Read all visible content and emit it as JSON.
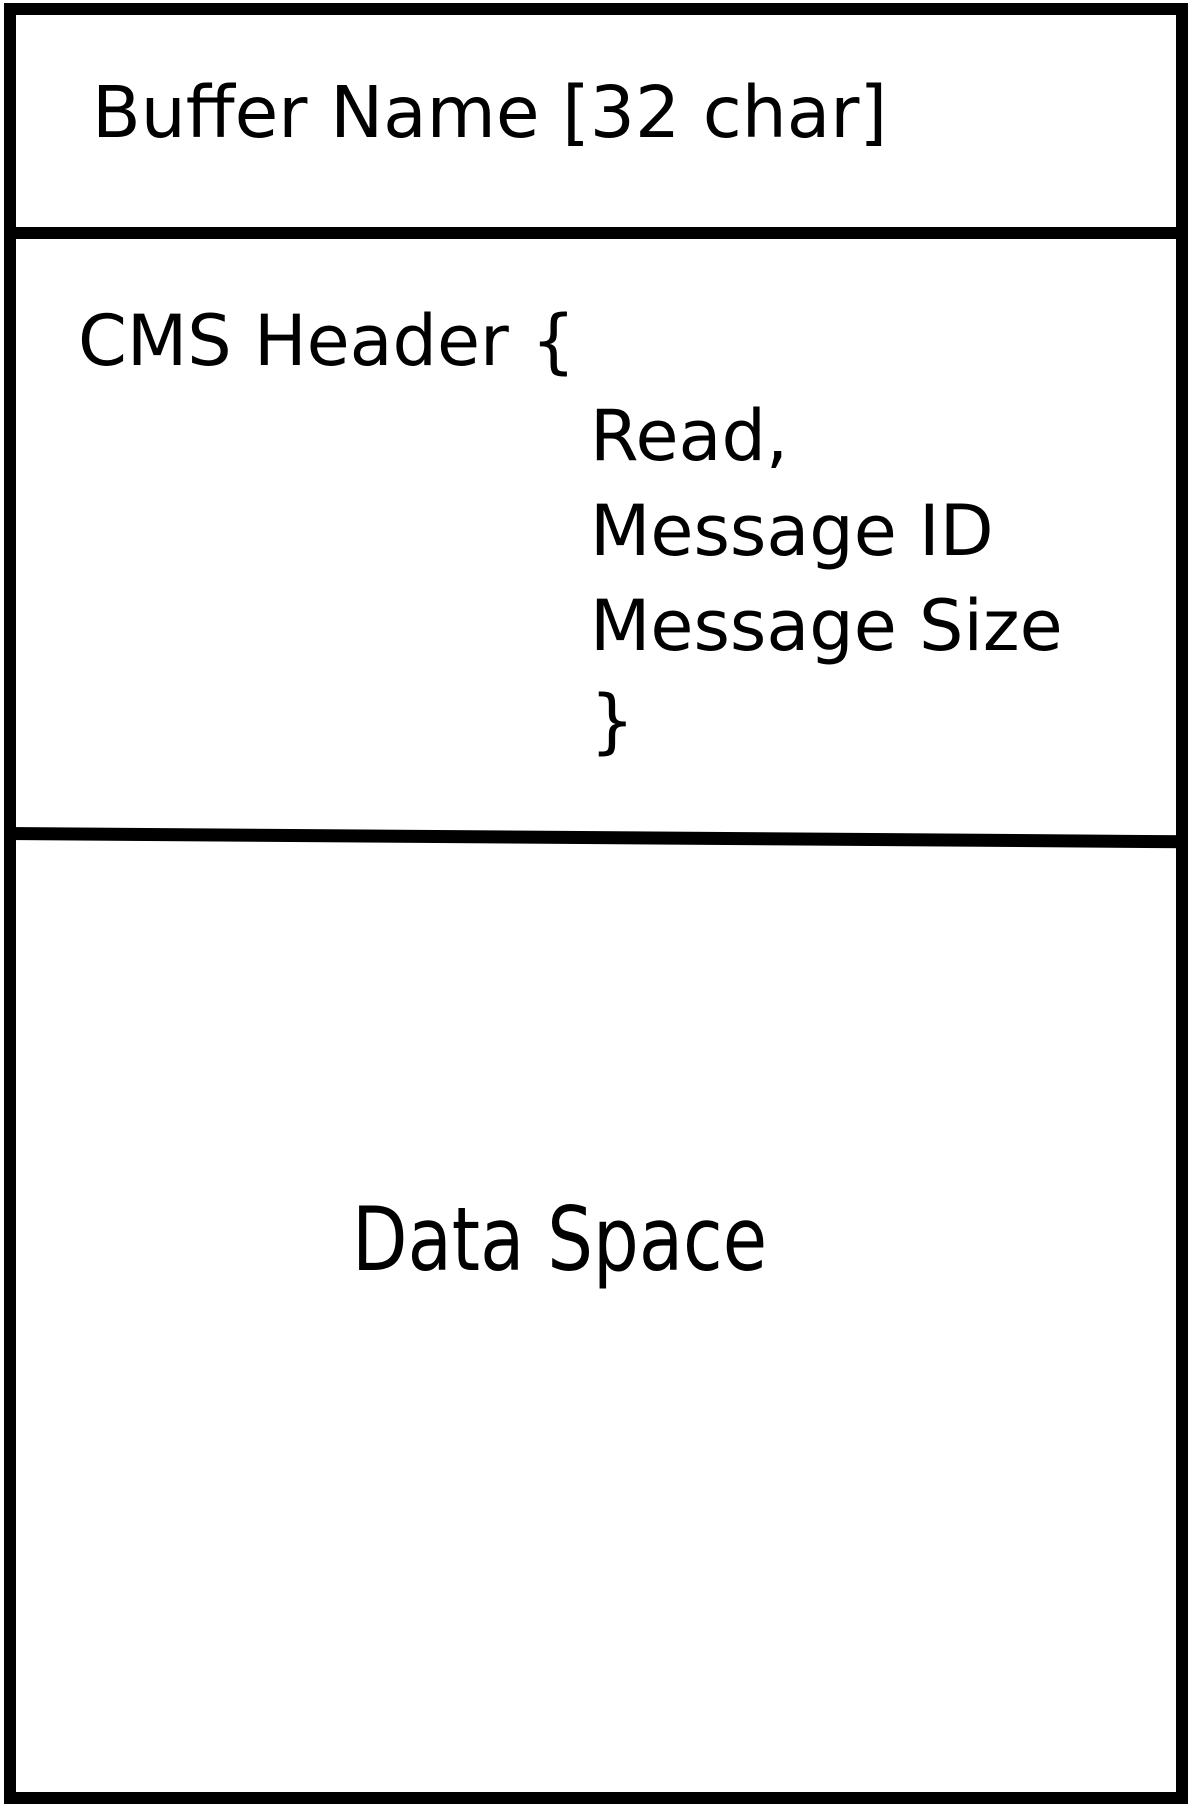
{
  "colors": {
    "background": "#ffffff",
    "line": "#000000",
    "text": "#000000"
  },
  "sections": [
    {
      "id": "buffer-name",
      "label": "Buffer Name [32 char]"
    },
    {
      "id": "cms-header",
      "lines": [
        "CMS Header {",
        "Read,",
        "Message ID",
        "Message Size",
        "}"
      ]
    },
    {
      "id": "data-space",
      "label": "Data Space"
    }
  ]
}
